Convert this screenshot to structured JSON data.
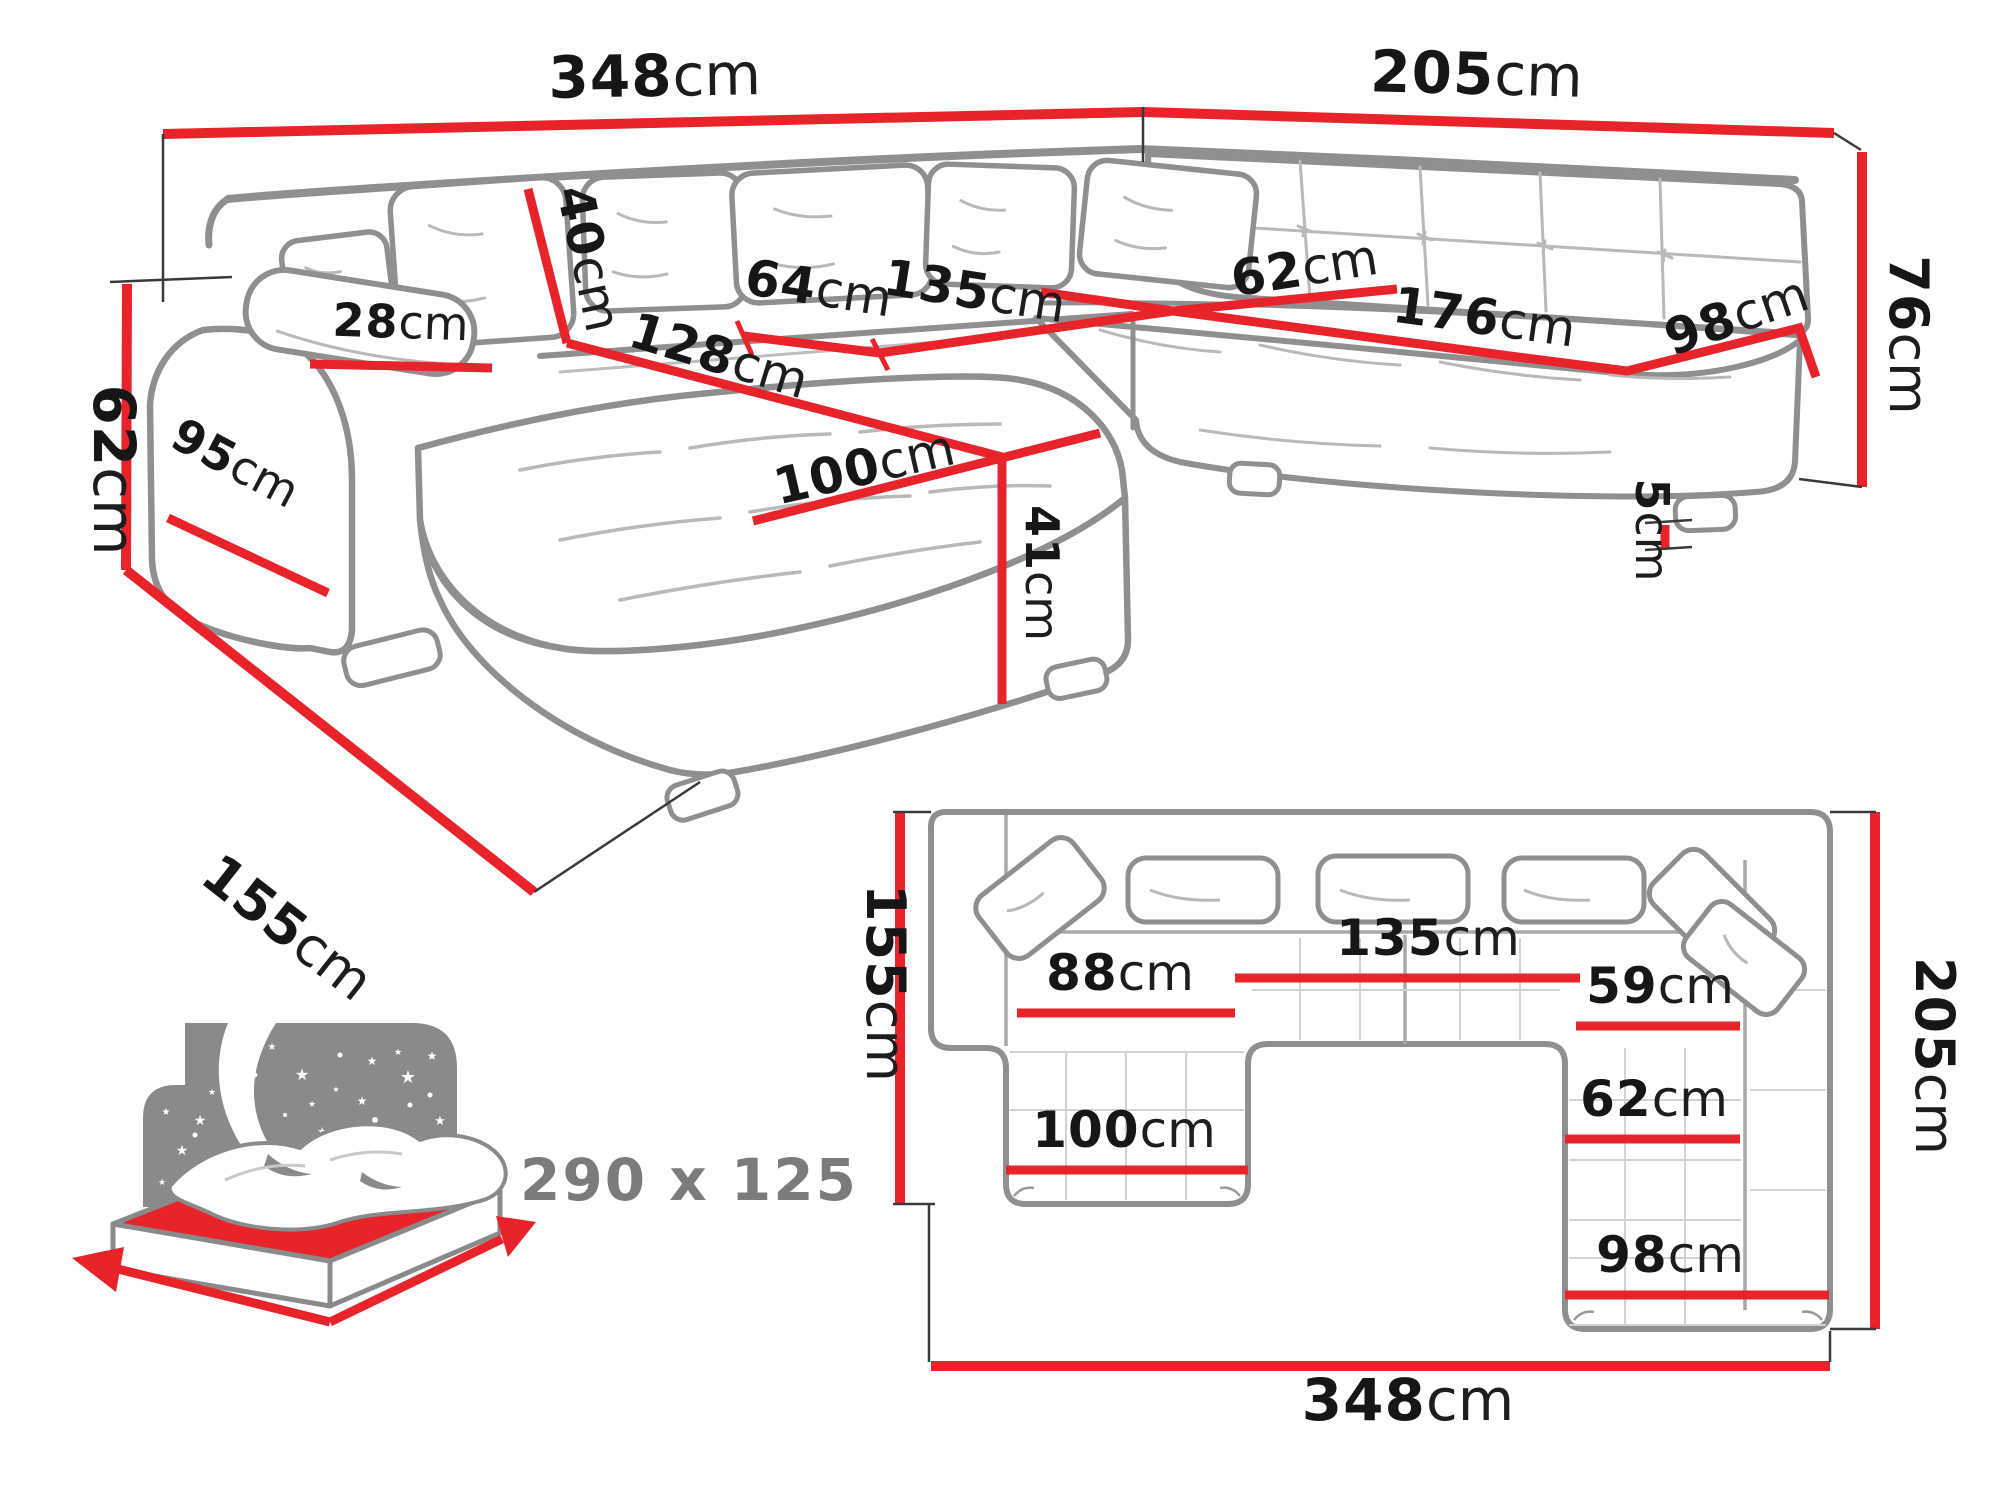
{
  "diagram_type": "sofa-dimension-diagram",
  "subject": "U-shaped corner sofa bed with sleeping function",
  "colors": {
    "dimension_red": "#e8232a",
    "sofa_outline_grey": "#8f8f8f",
    "sofa_inner_grey": "#b5b5b5",
    "label_black": "#161616",
    "muted_grey": "#7b7b7b",
    "bed_icon_grey": "#8a8a8a",
    "bed_mattress_red": "#e8232a"
  },
  "persp": {
    "d348": {
      "v": "348",
      "u": "cm"
    },
    "d205": {
      "v": "205",
      "u": "cm"
    },
    "d62_left": {
      "v": "62",
      "u": "cm"
    },
    "d155": {
      "v": "155",
      "u": "cm"
    },
    "d76": {
      "v": "76",
      "u": "cm"
    },
    "d40": {
      "v": "40",
      "u": "cm"
    },
    "d28": {
      "v": "28",
      "u": "cm"
    },
    "d95": {
      "v": "95",
      "u": "cm"
    },
    "d64": {
      "v": "64",
      "u": "cm"
    },
    "d135": {
      "v": "135",
      "u": "cm"
    },
    "d128": {
      "v": "128",
      "u": "cm"
    },
    "d100": {
      "v": "100",
      "u": "cm"
    },
    "d41": {
      "v": "41",
      "u": "cm"
    },
    "d62_corner": {
      "v": "62",
      "u": "cm"
    },
    "d176": {
      "v": "176",
      "u": "cm"
    },
    "d98": {
      "v": "98",
      "u": "cm"
    },
    "d5": {
      "v": "5",
      "u": "cm"
    }
  },
  "plan": {
    "d155": {
      "v": "155",
      "u": "cm"
    },
    "d205": {
      "v": "205",
      "u": "cm"
    },
    "d348": {
      "v": "348",
      "u": "cm"
    },
    "d88": {
      "v": "88",
      "u": "cm"
    },
    "d135": {
      "v": "135",
      "u": "cm"
    },
    "d59": {
      "v": "59",
      "u": "cm"
    },
    "d62": {
      "v": "62",
      "u": "cm"
    },
    "d100": {
      "v": "100",
      "u": "cm"
    },
    "d98": {
      "v": "98",
      "u": "cm"
    }
  },
  "bed": {
    "sleeping_area": "290 x 125"
  }
}
